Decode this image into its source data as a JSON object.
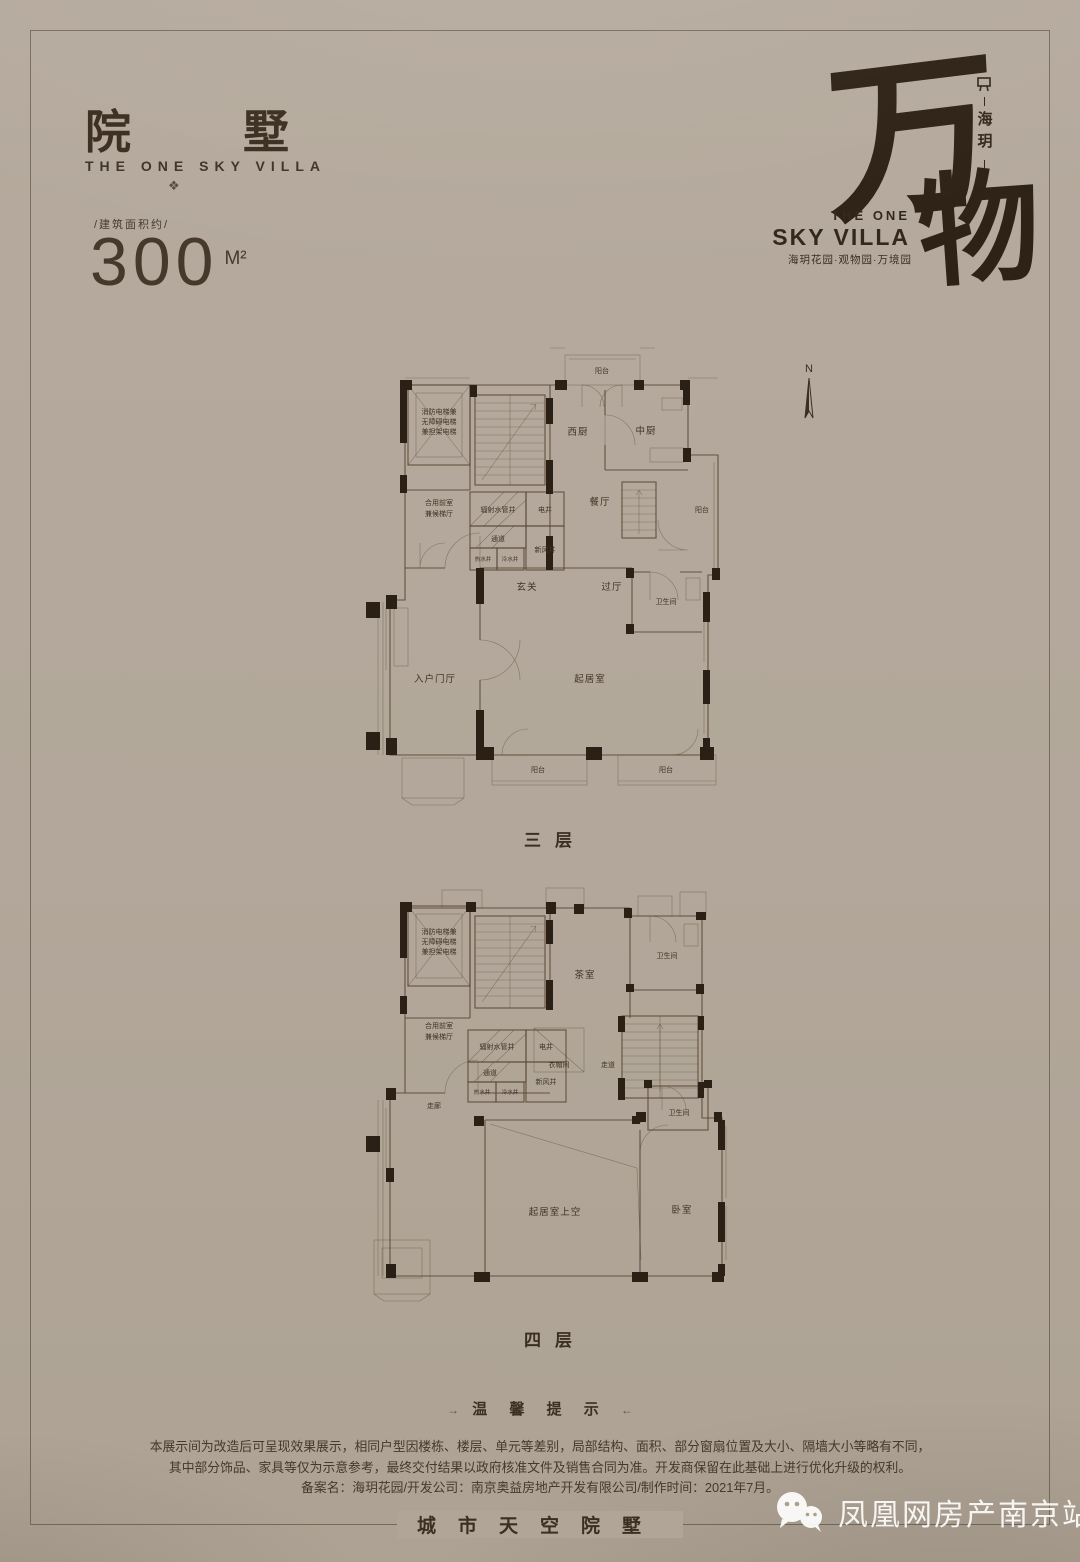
{
  "colors": {
    "background": "#b2a79a",
    "ink": "#3a2d21",
    "plan_line": "#5b4836",
    "wall_fill": "#2b2015",
    "watermark": "#ffffff"
  },
  "header": {
    "title": "院墅",
    "subtitle": "THE ONE SKY VILLA",
    "ornament": "❖",
    "area_label": "/建筑面积约/",
    "area_value": "300",
    "area_unit": "M²"
  },
  "brand": {
    "calligraphy_char1": "万",
    "calligraphy_char2": "物",
    "vertical_text": "海玥",
    "en_line1": "THE ONE",
    "en_line2": "SKY VILLA",
    "subtitle_cn": "海玥花园·观物园·万境园"
  },
  "compass": {
    "label": "N"
  },
  "plans": [
    {
      "caption": "三层",
      "labels": {
        "balcony_top": "阳台",
        "elevator_l1": "消防电梯兼",
        "elevator_l2": "无障碍电梯",
        "elevator_l3": "兼担架电梯",
        "lobby_l1": "合用前室",
        "lobby_l2": "兼候梯厅",
        "pipe_shaft": "辐射水管井",
        "electric_shaft": "电井",
        "passage": "通道",
        "hot_water": "热水井",
        "cold_water": "冷水井",
        "fresh_air_shaft": "新风井",
        "west_kitchen": "西厨",
        "chinese_kitchen": "中厨",
        "dining": "餐厅",
        "balcony_right": "阳台",
        "foyer": "玄关",
        "hallway": "过厅",
        "bathroom": "卫生间",
        "entry_hall": "入户门厅",
        "living": "起居室",
        "balcony_bottom_left": "阳台",
        "balcony_bottom_right": "阳台"
      }
    },
    {
      "caption": "四层",
      "labels": {
        "elevator_l1": "消防电梯兼",
        "elevator_l2": "无障碍电梯",
        "elevator_l3": "兼担架电梯",
        "lobby_l1": "合用前室",
        "lobby_l2": "兼候梯厅",
        "pipe_shaft": "辐射水管井",
        "electric_shaft": "电井",
        "passage": "通道",
        "hot_water": "热水井",
        "cold_water": "冷水井",
        "fresh_air_shaft": "新风井",
        "tea_room": "茶室",
        "bathroom_top": "卫生间",
        "cloakroom": "衣帽间",
        "aisle": "走道",
        "corridor": "走廊",
        "living_void": "起居室上空",
        "bedroom": "卧室",
        "bathroom_bottom": "卫生间"
      }
    }
  ],
  "notice": {
    "arrow_left": "→",
    "title": "温 馨 提 示",
    "arrow_right": "←",
    "lines": [
      "本展示间为改造后可呈现效果展示，相同户型因楼栋、楼层、单元等差别，局部结构、面积、部分窗扇位置及大小、隔墙大小等略有不同，",
      "其中部分饰品、家具等仅为示意参考，最终交付结果以政府核准文件及销售合同为准。开发商保留在此基础上进行优化升级的权利。",
      "备案名：海玥花园/开发公司：南京奥益房地产开发有限公司/制作时间：2021年7月。"
    ]
  },
  "footer": {
    "slogan": "城市天空院墅"
  },
  "watermark": {
    "text": "凤凰网房产南京站"
  }
}
